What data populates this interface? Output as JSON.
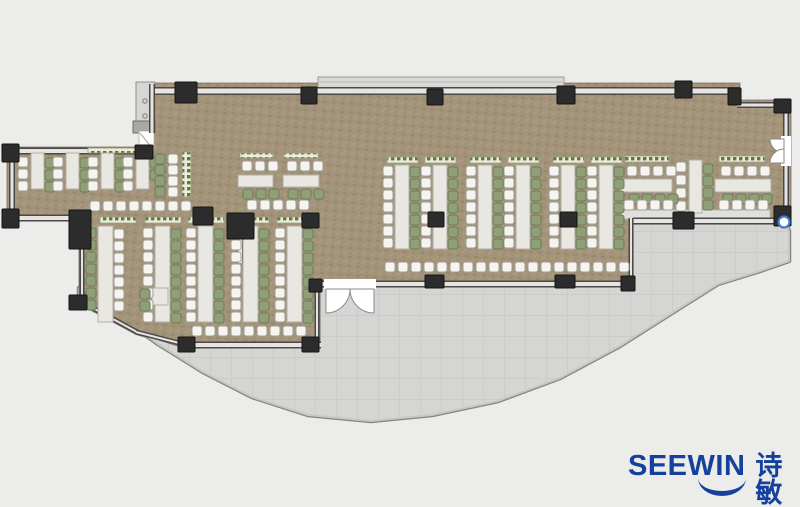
{
  "logo": {
    "brand": "SEEWIN",
    "brand_cn": "诗敏",
    "color": "#15409d",
    "x": 628,
    "y": 452
  },
  "canvas": {
    "w": 800,
    "h": 507,
    "bg": "#ececeb"
  },
  "colors": {
    "wood_base": "#a39379",
    "wood_light": "#b2a38c",
    "wood_mid": "#ac9d86",
    "wood_dark": "#8e7f69",
    "terrace": "#d5d6d3",
    "terrace_grid": "#caccc9",
    "terrace_edge": "#84867f",
    "terrace_band": "#c6c8c5",
    "wall_dark": "#4a4947",
    "wall_fill": "#e6e5e2",
    "column": "#2d2c2d",
    "column_stroke": "#151515",
    "chair_white": "#f5f4f0",
    "chair_white_border": "#a19e96",
    "chair_green": "#8fa078",
    "chair_green_border": "#6c7c55",
    "table": "#e9e7e1",
    "table_border": "#b2afa7",
    "planter_bg": "#edebdf",
    "planter_dot": "#5c7c34",
    "planter_border": "#9aa37e",
    "ledge": "#d9dad7",
    "ledge_border": "#98镇9896",
    "door_fill": "#ffffff",
    "door_arc": "#8a8a88",
    "marker": "#3a78d2",
    "panel": "#d6d6d4",
    "panel_border": "#8f8f8d",
    "block": "#a8a8a5"
  },
  "wood_floor": [
    [
      152,
      83
    ],
    [
      740,
      83
    ],
    [
      740,
      100
    ],
    [
      791,
      100
    ],
    [
      791,
      224
    ],
    [
      633,
      224
    ],
    [
      633,
      285
    ],
    [
      320,
      285
    ],
    [
      320,
      348
    ],
    [
      184,
      348
    ],
    [
      136,
      333
    ],
    [
      79,
      302
    ],
    [
      79,
      221
    ],
    [
      7,
      221
    ],
    [
      7,
      147
    ],
    [
      151,
      147
    ]
  ],
  "terrace": [
    [
      633,
      224
    ],
    [
      786,
      224
    ],
    [
      789,
      231
    ],
    [
      789,
      261
    ],
    [
      757,
      272
    ],
    [
      718,
      284
    ],
    [
      672,
      313
    ],
    [
      620,
      346
    ],
    [
      560,
      378
    ],
    [
      498,
      401
    ],
    [
      432,
      415
    ],
    [
      371,
      421
    ],
    [
      308,
      415
    ],
    [
      252,
      397
    ],
    [
      203,
      372
    ],
    [
      158,
      344
    ],
    [
      118,
      315
    ],
    [
      90,
      296
    ],
    [
      79,
      288
    ],
    [
      79,
      302
    ],
    [
      137,
      333
    ],
    [
      185,
      347
    ],
    [
      320,
      347
    ],
    [
      320,
      284
    ],
    [
      633,
      284
    ]
  ],
  "ledge": {
    "x": 318,
    "y": 77,
    "w": 246,
    "h": 16
  },
  "nw_panel": {
    "panel": [
      136,
      82,
      19,
      45
    ],
    "circles": [
      [
        145,
        101
      ],
      [
        145,
        116
      ]
    ],
    "block": [
      133,
      121,
      22,
      12
    ],
    "door": [
      139,
      131,
      15,
      19
    ],
    "door_line": [
      140,
      133,
      152,
      148
    ]
  },
  "walls": [
    [
      152,
      91,
      740,
      91,
      8
    ],
    [
      737,
      91,
      737,
      105,
      6
    ],
    [
      737,
      105,
      791,
      105,
      6
    ],
    [
      786,
      105,
      786,
      139,
      6
    ],
    [
      786,
      163,
      786,
      223,
      6
    ],
    [
      633,
      221,
      791,
      221,
      7
    ],
    [
      631,
      218,
      631,
      286,
      5
    ],
    [
      318,
      284,
      634,
      284,
      7
    ],
    [
      317,
      284,
      317,
      347,
      5
    ],
    [
      183,
      345,
      321,
      345,
      7
    ],
    [
      80,
      301,
      137,
      332,
      5
    ],
    [
      136,
      332,
      187,
      345,
      5
    ],
    [
      82,
      238,
      82,
      303,
      5
    ],
    [
      8,
      218,
      82,
      218,
      7
    ],
    [
      12,
      148,
      12,
      220,
      6
    ],
    [
      6,
      151,
      153,
      151,
      7
    ],
    [
      152,
      84,
      152,
      133,
      6
    ],
    [
      240,
      238,
      240,
      263,
      7
    ]
  ],
  "columns": [
    [
      175,
      82,
      22,
      21
    ],
    [
      301,
      87,
      16,
      17
    ],
    [
      427,
      89,
      16,
      16
    ],
    [
      557,
      86,
      18,
      18
    ],
    [
      675,
      81,
      17,
      17
    ],
    [
      728,
      88,
      13,
      17
    ],
    [
      774,
      99,
      17,
      14
    ],
    [
      774,
      206,
      17,
      20
    ],
    [
      673,
      212,
      21,
      17
    ],
    [
      621,
      276,
      14,
      15
    ],
    [
      555,
      275,
      20,
      13
    ],
    [
      425,
      275,
      19,
      13
    ],
    [
      309,
      279,
      13,
      13
    ],
    [
      302,
      337,
      17,
      15
    ],
    [
      178,
      337,
      17,
      15
    ],
    [
      69,
      295,
      18,
      15
    ],
    [
      69,
      210,
      22,
      39
    ],
    [
      227,
      213,
      27,
      26
    ],
    [
      193,
      207,
      20,
      18
    ],
    [
      302,
      213,
      17,
      15
    ],
    [
      428,
      212,
      16,
      15
    ],
    [
      560,
      212,
      17,
      15
    ],
    [
      2,
      144,
      17,
      18
    ],
    [
      2,
      209,
      17,
      19
    ],
    [
      135,
      145,
      18,
      14
    ]
  ],
  "counter": [
    621,
    210,
    149,
    9
  ],
  "tables": [
    [
      31,
      153,
      13,
      36
    ],
    [
      66,
      153,
      13,
      36
    ],
    [
      101,
      153,
      13,
      36
    ],
    [
      136,
      153,
      13,
      36
    ],
    [
      238,
      175,
      35,
      12
    ],
    [
      283,
      175,
      36,
      12
    ],
    [
      395,
      165,
      14,
      84
    ],
    [
      433,
      165,
      14,
      84
    ],
    [
      478,
      165,
      14,
      84
    ],
    [
      516,
      165,
      14,
      84
    ],
    [
      561,
      165,
      14,
      84
    ],
    [
      599,
      165,
      14,
      84
    ],
    [
      98,
      226,
      15,
      96
    ],
    [
      155,
      226,
      15,
      96
    ],
    [
      198,
      226,
      15,
      96
    ],
    [
      243,
      226,
      15,
      96
    ],
    [
      287,
      226,
      15,
      96
    ],
    [
      152,
      288,
      16,
      17
    ],
    [
      620,
      179,
      52,
      13
    ],
    [
      715,
      179,
      56,
      13
    ],
    [
      689,
      160,
      13,
      53
    ]
  ],
  "planters": [
    [
      88,
      148,
      62,
      5
    ],
    [
      182,
      152,
      9,
      45
    ],
    [
      240,
      153,
      33,
      5
    ],
    [
      284,
      153,
      34,
      5
    ],
    [
      387,
      157,
      31,
      6
    ],
    [
      425,
      157,
      31,
      6
    ],
    [
      470,
      157,
      31,
      6
    ],
    [
      508,
      157,
      31,
      6
    ],
    [
      553,
      157,
      31,
      6
    ],
    [
      591,
      157,
      31,
      6
    ],
    [
      100,
      217,
      36,
      6
    ],
    [
      145,
      217,
      36,
      6
    ],
    [
      188,
      217,
      36,
      6
    ],
    [
      233,
      217,
      36,
      6
    ],
    [
      277,
      217,
      36,
      6
    ],
    [
      625,
      156,
      44,
      6
    ],
    [
      719,
      156,
      46,
      6
    ]
  ],
  "chair_cols": [
    {
      "x": 18,
      "y": 157,
      "n": 3,
      "p": 12,
      "c": "w"
    },
    {
      "x": 45,
      "y": 158,
      "n": 3,
      "p": 12,
      "c": "g"
    },
    {
      "x": 53,
      "y": 157,
      "n": 3,
      "p": 12,
      "c": "w"
    },
    {
      "x": 80,
      "y": 158,
      "n": 3,
      "p": 12,
      "c": "g"
    },
    {
      "x": 88,
      "y": 157,
      "n": 3,
      "p": 12,
      "c": "w"
    },
    {
      "x": 115,
      "y": 158,
      "n": 3,
      "p": 12,
      "c": "g"
    },
    {
      "x": 123,
      "y": 157,
      "n": 3,
      "p": 12,
      "c": "w"
    },
    {
      "x": 150,
      "y": 158,
      "n": 2,
      "p": 12,
      "c": "g"
    },
    {
      "x": 155,
      "y": 154,
      "n": 4,
      "p": 11,
      "c": "g"
    },
    {
      "x": 168,
      "y": 154,
      "n": 4,
      "p": 11,
      "c": "w"
    },
    {
      "x": 383,
      "y": 166,
      "n": 7,
      "p": 12,
      "c": "w"
    },
    {
      "x": 410,
      "y": 167,
      "n": 7,
      "p": 12,
      "c": "g"
    },
    {
      "x": 421,
      "y": 166,
      "n": 7,
      "p": 12,
      "c": "w"
    },
    {
      "x": 448,
      "y": 167,
      "n": 7,
      "p": 12,
      "c": "g"
    },
    {
      "x": 466,
      "y": 166,
      "n": 7,
      "p": 12,
      "c": "w"
    },
    {
      "x": 493,
      "y": 167,
      "n": 7,
      "p": 12,
      "c": "g"
    },
    {
      "x": 504,
      "y": 166,
      "n": 7,
      "p": 12,
      "c": "w"
    },
    {
      "x": 531,
      "y": 167,
      "n": 7,
      "p": 12,
      "c": "g"
    },
    {
      "x": 549,
      "y": 166,
      "n": 7,
      "p": 12,
      "c": "w"
    },
    {
      "x": 576,
      "y": 167,
      "n": 7,
      "p": 12,
      "c": "g"
    },
    {
      "x": 587,
      "y": 166,
      "n": 7,
      "p": 12,
      "c": "w"
    },
    {
      "x": 614,
      "y": 167,
      "n": 7,
      "p": 12,
      "c": "g"
    },
    {
      "x": 86,
      "y": 228,
      "n": 7,
      "p": 12,
      "c": "g"
    },
    {
      "x": 114,
      "y": 229,
      "n": 7,
      "p": 12,
      "c": "w"
    },
    {
      "x": 143,
      "y": 228,
      "n": 8,
      "p": 12,
      "c": "w"
    },
    {
      "x": 171,
      "y": 229,
      "n": 8,
      "p": 12,
      "c": "g"
    },
    {
      "x": 186,
      "y": 228,
      "n": 8,
      "p": 12,
      "c": "w"
    },
    {
      "x": 214,
      "y": 229,
      "n": 8,
      "p": 12,
      "c": "g"
    },
    {
      "x": 231,
      "y": 228,
      "n": 8,
      "p": 12,
      "c": "w"
    },
    {
      "x": 259,
      "y": 229,
      "n": 8,
      "p": 12,
      "c": "g"
    },
    {
      "x": 275,
      "y": 228,
      "n": 8,
      "p": 12,
      "c": "w"
    },
    {
      "x": 303,
      "y": 229,
      "n": 8,
      "p": 12,
      "c": "g"
    },
    {
      "x": 140,
      "y": 289,
      "n": 2,
      "p": 12,
      "c": "g"
    },
    {
      "x": 676,
      "y": 162,
      "n": 4,
      "p": 13,
      "c": "w"
    },
    {
      "x": 703,
      "y": 164,
      "n": 4,
      "p": 12,
      "c": "g"
    }
  ],
  "chair_rows": [
    {
      "x": 242,
      "y": 161,
      "n": 3,
      "p": 13,
      "c": "w"
    },
    {
      "x": 243,
      "y": 189,
      "n": 3,
      "p": 13,
      "c": "g"
    },
    {
      "x": 287,
      "y": 161,
      "n": 3,
      "p": 13,
      "c": "w"
    },
    {
      "x": 288,
      "y": 189,
      "n": 3,
      "p": 13,
      "c": "g"
    },
    {
      "x": 90,
      "y": 201,
      "n": 8,
      "p": 13,
      "c": "w"
    },
    {
      "x": 247,
      "y": 200,
      "n": 5,
      "p": 13,
      "c": "w"
    },
    {
      "x": 385,
      "y": 262,
      "n": 19,
      "p": 13,
      "c": "w"
    },
    {
      "x": 192,
      "y": 326,
      "n": 9,
      "p": 13,
      "c": "w"
    },
    {
      "x": 627,
      "y": 166,
      "n": 4,
      "p": 13,
      "c": "w"
    },
    {
      "x": 721,
      "y": 166,
      "n": 4,
      "p": 13,
      "c": "w"
    },
    {
      "x": 629,
      "y": 194,
      "n": 4,
      "p": 13,
      "c": "g"
    },
    {
      "x": 723,
      "y": 194,
      "n": 4,
      "p": 13,
      "c": "g"
    },
    {
      "x": 624,
      "y": 200,
      "n": 4,
      "p": 13,
      "c": "w"
    },
    {
      "x": 719,
      "y": 200,
      "n": 4,
      "p": 13,
      "c": "w"
    }
  ],
  "doors": {
    "south_double": {
      "mask": [
        324,
        279,
        52,
        10
      ],
      "fans": [
        "M350,289 A24,24 0 0 1 326,313 L326,289 Z",
        "M350,289 A24,24 0 0 0 374,313 L374,289 Z"
      ]
    },
    "east_double": {
      "mask": [
        781,
        136,
        10,
        30
      ],
      "fans": [
        "M784,153 A14,14 0 0 1 770,139 L784,139 Z",
        "M784,149 A14,14 0 0 0 770,163 L784,163 Z"
      ]
    }
  },
  "marker": {
    "cx": 784,
    "cy": 222,
    "r": 5.5
  }
}
